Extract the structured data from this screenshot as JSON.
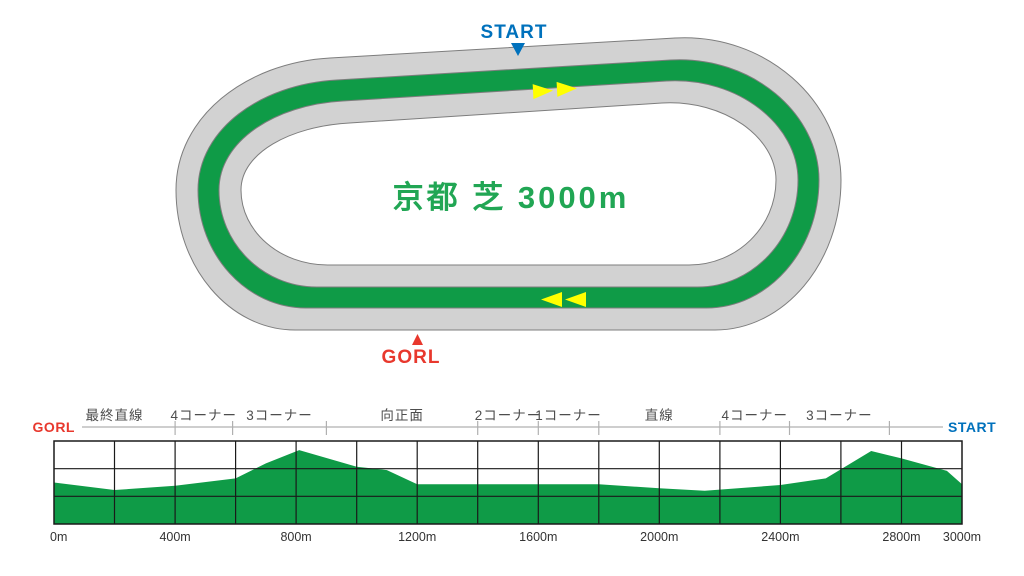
{
  "course_map": {
    "title": "京都 芝 3000m",
    "start_label": "START",
    "goal_label": "GORL"
  },
  "colors": {
    "track_gray": "#d2d2d2",
    "turf_green": "#0f9b47",
    "outline_gray": "#7d7d7d",
    "start_blue": "#0071bc",
    "goal_red": "#e8382d",
    "arrow_yellow": "#ffff00",
    "title_green": "#21a654",
    "grid_black": "#1a1a1a",
    "guide_gray": "#b0b0b0",
    "section_label_gray": "#4d4d4d",
    "axis_label_dark": "#333333",
    "background": "#ffffff"
  },
  "chart_data": {
    "type": "area",
    "x_unit": "m",
    "xlim": [
      0,
      3000
    ],
    "left_end_label": "GORL",
    "right_end_label": "START",
    "grid_interval_m": 200,
    "h_grid_rows": 3,
    "sections": [
      {
        "label": "最終直線",
        "from": 0,
        "to": 400
      },
      {
        "label": "4コーナー",
        "from": 400,
        "to": 590
      },
      {
        "label": "3コーナー",
        "from": 590,
        "to": 900
      },
      {
        "label": "向正面",
        "from": 900,
        "to": 1400
      },
      {
        "label": "2コーナー",
        "from": 1400,
        "to": 1600
      },
      {
        "label": "1コーナー",
        "from": 1600,
        "to": 1800
      },
      {
        "label": "直線",
        "from": 1800,
        "to": 2200
      },
      {
        "label": "4コーナー",
        "from": 2200,
        "to": 2430
      },
      {
        "label": "3コーナー",
        "from": 2430,
        "to": 2760
      },
      {
        "label": "",
        "from": 2760,
        "to": 3000
      }
    ],
    "distance_ticks": [
      {
        "value": 0,
        "label": "0m"
      },
      {
        "value": 400,
        "label": "400m"
      },
      {
        "value": 800,
        "label": "800m"
      },
      {
        "value": 1200,
        "label": "1200m"
      },
      {
        "value": 1600,
        "label": "1600m"
      },
      {
        "value": 2000,
        "label": "2000m"
      },
      {
        "value": 2400,
        "label": "2400m"
      },
      {
        "value": 2800,
        "label": "2800m"
      },
      {
        "value": 3000,
        "label": "3000m"
      }
    ],
    "elevation_profile_note": "x in meters, h as fraction of chart height above chart bottom",
    "elevation_profile": [
      [
        0,
        0.5
      ],
      [
        200,
        0.41
      ],
      [
        400,
        0.46
      ],
      [
        600,
        0.55
      ],
      [
        700,
        0.73
      ],
      [
        810,
        0.89
      ],
      [
        1000,
        0.69
      ],
      [
        1100,
        0.65
      ],
      [
        1200,
        0.48
      ],
      [
        1500,
        0.48
      ],
      [
        1800,
        0.48
      ],
      [
        2000,
        0.43
      ],
      [
        2150,
        0.4
      ],
      [
        2400,
        0.47
      ],
      [
        2550,
        0.55
      ],
      [
        2700,
        0.88
      ],
      [
        2800,
        0.79
      ],
      [
        2950,
        0.64
      ],
      [
        3000,
        0.48
      ]
    ]
  }
}
